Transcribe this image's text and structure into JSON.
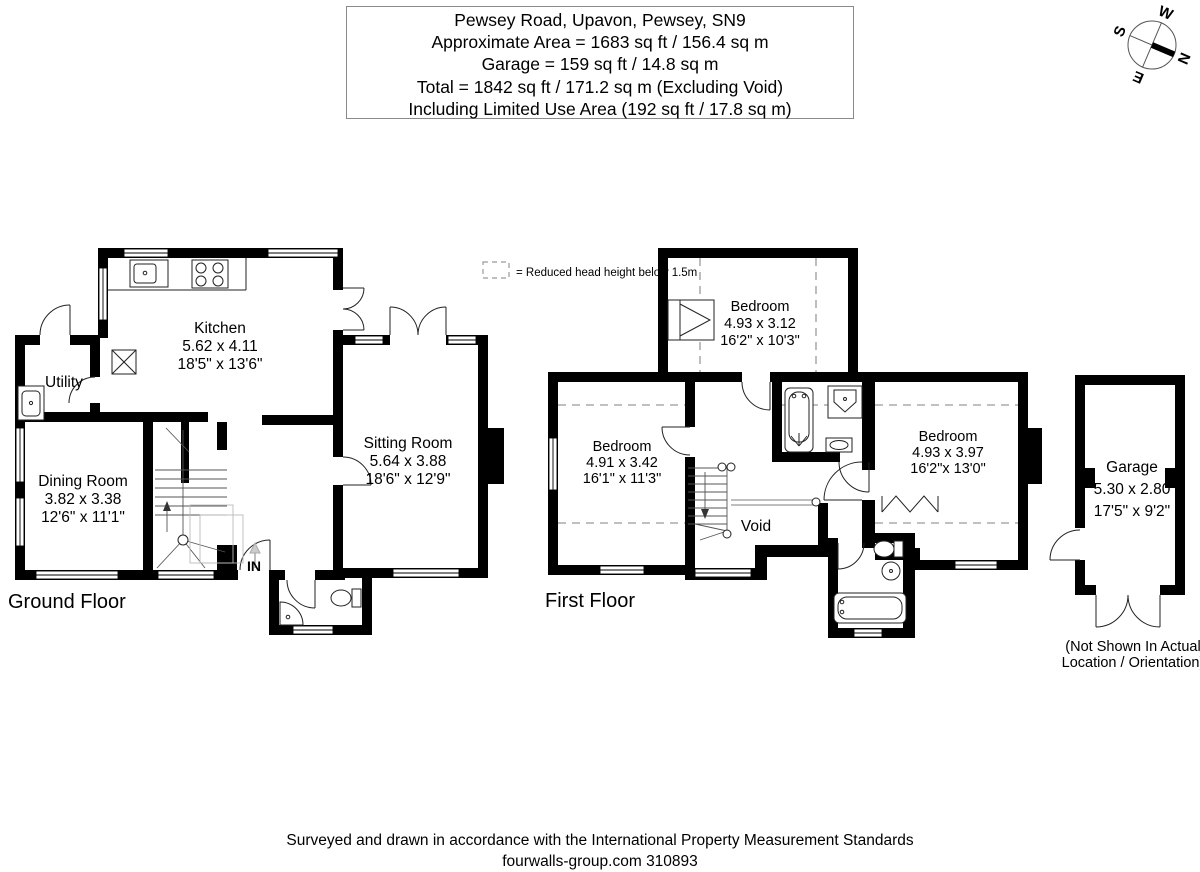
{
  "header": {
    "address": "Pewsey Road, Upavon, Pewsey, SN9",
    "line2": "Approximate Area = 1683 sq ft / 156.4 sq m",
    "line3": "Garage = 159 sq ft / 14.8 sq m",
    "line4": "Total = 1842 sq ft / 171.2 sq m (Excluding Void)",
    "line5": "Including Limited Use Area (192 sq ft / 17.8 sq m)"
  },
  "compass": {
    "north": "N",
    "east": "E",
    "south": "S",
    "west": "W"
  },
  "legend": {
    "label": "= Reduced head height below 1.5m"
  },
  "ground": {
    "floor_label": "Ground Floor",
    "entrance_label": "IN",
    "kitchen": {
      "name": "Kitchen",
      "metric": "5.62 x 4.11",
      "imperial": "18'5\" x 13'6\""
    },
    "utility": {
      "name": "Utility"
    },
    "dining": {
      "name": "Dining Room",
      "metric": "3.82 x 3.38",
      "imperial": "12'6\" x 11'1\""
    },
    "sitting": {
      "name": "Sitting Room",
      "metric": "5.64 x 3.88",
      "imperial": "18'6\" x 12'9\""
    }
  },
  "first": {
    "floor_label": "First Floor",
    "void_label": "Void",
    "bedroom_top": {
      "name": "Bedroom",
      "metric": "4.93 x 3.12",
      "imperial": "16'2\" x 10'3\""
    },
    "bedroom_left": {
      "name": "Bedroom",
      "metric": "4.91 x 3.42",
      "imperial": "16'1\" x 11'3\""
    },
    "bedroom_right": {
      "name": "Bedroom",
      "metric": "4.93 x 3.97",
      "imperial": "16'2\"x 13'0\""
    }
  },
  "garage": {
    "room": {
      "name": "Garage",
      "metric": "5.30 x 2.80",
      "imperial": "17'5\" x 9'2\""
    },
    "note1": "(Not Shown In Actual",
    "note2": "Location / Orientation)"
  },
  "footer": {
    "line1": "Surveyed and drawn in accordance with the International Property Measurement Standards",
    "line2": "fourwalls-group.com 310893"
  },
  "colors": {
    "wall": "#000000",
    "reduced_head_dash": "#9a9a9a",
    "background": "#ffffff"
  }
}
